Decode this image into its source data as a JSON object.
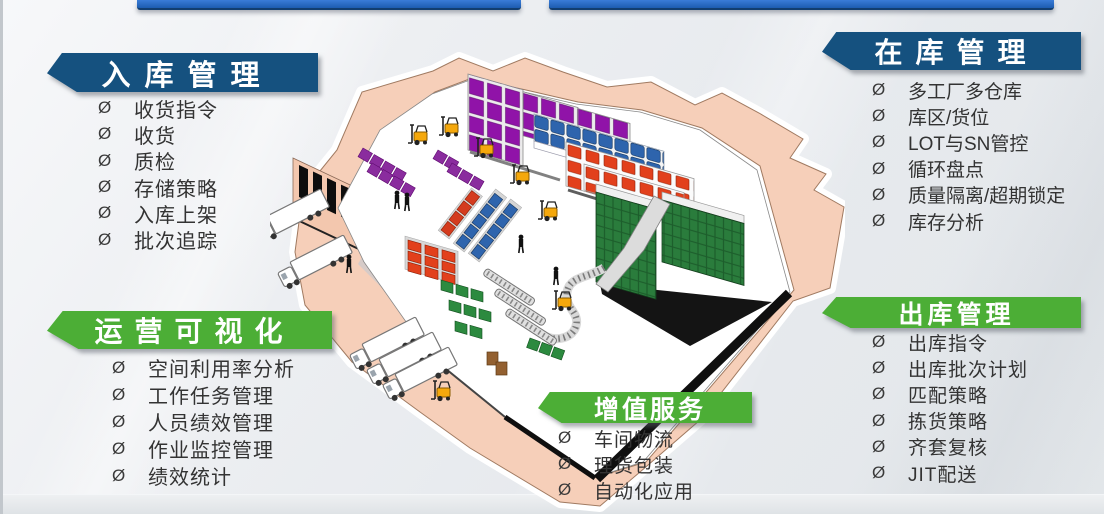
{
  "bullet": "Ø",
  "colors": {
    "header_blue": "#15517f",
    "header_green": "#4cae36",
    "top_bar_blue": "#1c5cb0",
    "list_text": "#333333",
    "platform_peach": "#f6cfb9",
    "rack_purple": "#9013a8",
    "rack_blue": "#2e64ad",
    "rack_red": "#e2401c",
    "rack_green": "#2a7c3c",
    "forklift_yellow": "#f5a80c"
  },
  "panels": {
    "inbound": {
      "title": "入库管理",
      "items": [
        "收货指令",
        "收货",
        "质检",
        "存储策略",
        "入库上架",
        "批次追踪"
      ]
    },
    "instock": {
      "title": "在库管理",
      "items": [
        "多工厂多仓库",
        "库区/货位",
        "LOT与SN管控",
        "循环盘点",
        "质量隔离/超期锁定",
        "库存分析"
      ]
    },
    "visualization": {
      "title": "运营可视化",
      "items": [
        "空间利用率分析",
        "工作任务管理",
        "人员绩效管理",
        "作业监控管理",
        "绩效统计"
      ]
    },
    "value_added": {
      "title": "增值服务",
      "items": [
        "车间物流",
        "理货包装",
        "自动化应用"
      ]
    },
    "outbound": {
      "title": "出库管理",
      "items": [
        "出库指令",
        "出库批次计划",
        "匹配策略",
        "拣货策略",
        "齐套复核",
        "JIT配送"
      ]
    }
  }
}
